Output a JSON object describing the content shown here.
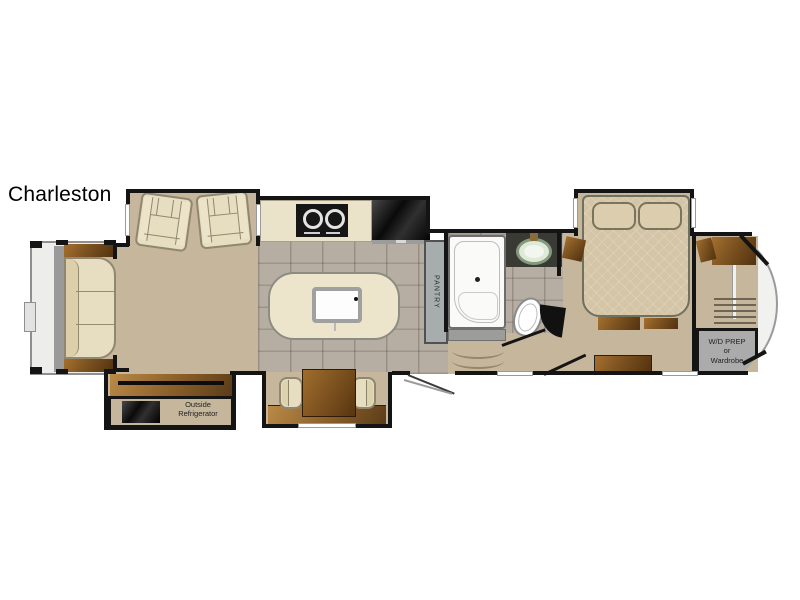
{
  "title": "Charleston",
  "labels": {
    "pantry": "PANTRY",
    "outside_fridge_line1": "Outside",
    "outside_fridge_line2": "Refrigerator",
    "wd_line1": "W/D PREP",
    "wd_line2": "or",
    "wd_line3": "Wardrobe"
  },
  "colors": {
    "wall": "#141414",
    "floor_tan": "#c6b69b",
    "tile_gray": "#b3aa9e",
    "island_cream": "#ece4cb",
    "counter_cream": "#ebe3c9",
    "wood_dark": "#52320f",
    "wood_light": "#a5702f",
    "upholstery_cream": "#e7dec1",
    "slide_gray": "#9a9a9a",
    "appliance_black": "#111111",
    "sink_green": "#dfe9d8",
    "wd_prep_gray": "#ababab"
  }
}
